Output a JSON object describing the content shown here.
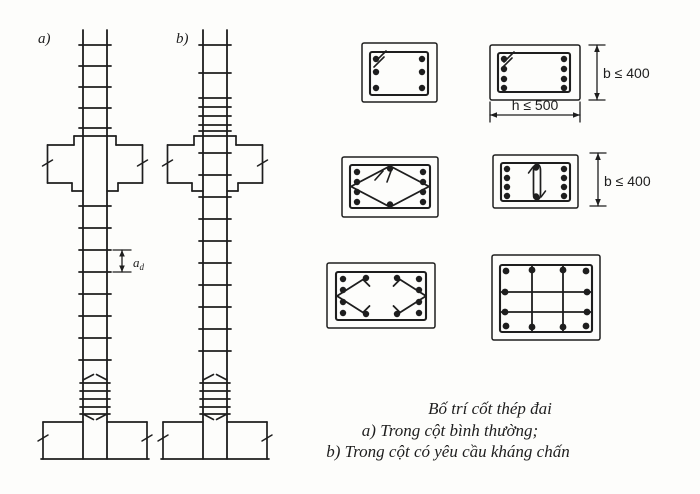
{
  "labels": {
    "column_a": "a)",
    "column_b": "b)",
    "spacing_symbol": "a",
    "spacing_subscript": "d"
  },
  "dimensions": {
    "b_max": "b ≤ 400",
    "h_max": "h ≤ 500"
  },
  "caption": {
    "title": "Bố trí cốt thép đai",
    "line_a": "a) Trong cột bình thường;",
    "line_b": "b) Trong cột có yêu cầu kháng chấn"
  },
  "colors": {
    "ink": "#1e1e1e",
    "paper": "#fdfdfb"
  }
}
